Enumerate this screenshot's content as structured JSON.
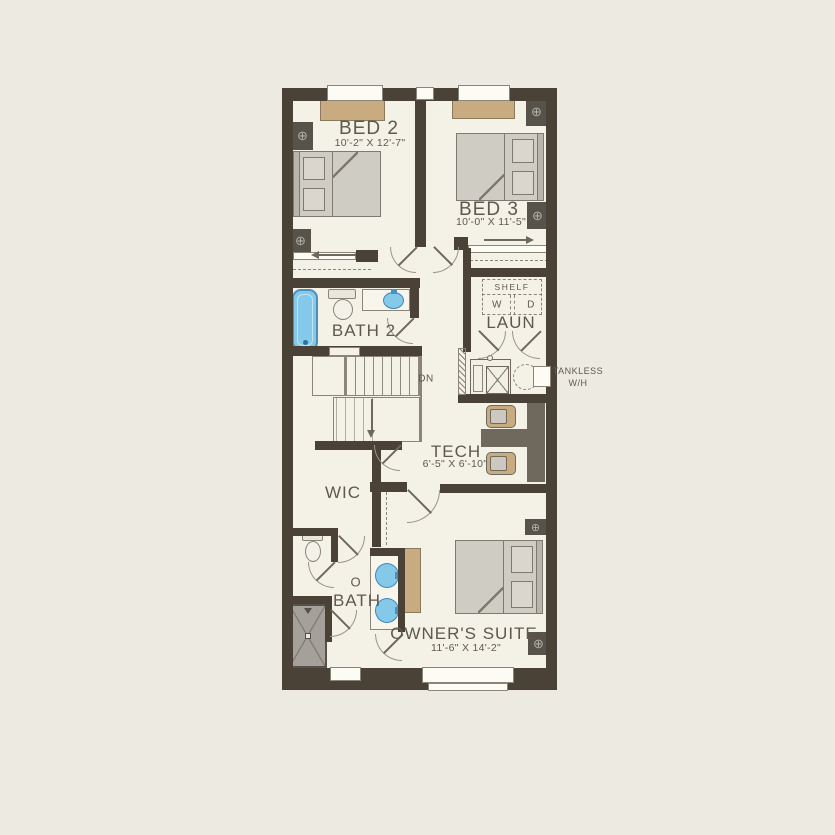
{
  "colors": {
    "background": "#edebe1",
    "floor": "#f4f1e7",
    "wall": "#4a4237",
    "text": "#5f594d",
    "accent_tan": "#c9ab81",
    "fixture_blue": "#85c9ea",
    "furniture_gray": "#cfccc3",
    "shower_gray": "#a5a19a",
    "desk_brown": "#6f695d",
    "window": "#fcfbf4"
  },
  "rooms": {
    "bed2": {
      "name": "BED 2",
      "dims": "10'-2\" X 12'-7\""
    },
    "bed3": {
      "name": "BED 3",
      "dims": "10'-0\" X 11'-5\""
    },
    "bath2": {
      "name": "BATH 2"
    },
    "laundry": {
      "name": "LAUN",
      "shelf_label": "SHELF",
      "washer_label": "W",
      "dryer_label": "D"
    },
    "tech": {
      "name": "TECH",
      "dims": "6'-5\" X 6'-10\""
    },
    "wic": {
      "name": "WIC"
    },
    "owner_bath": {
      "prefix": "O",
      "name": "BATH"
    },
    "owner_suite": {
      "name": "OWNER'S SUITE",
      "dims": "11'-6\" X 14'-2\""
    }
  },
  "annotations": {
    "stairs_down": "DN",
    "water_heater_line1": "TANKLESS",
    "water_heater_line2": "W/H"
  }
}
